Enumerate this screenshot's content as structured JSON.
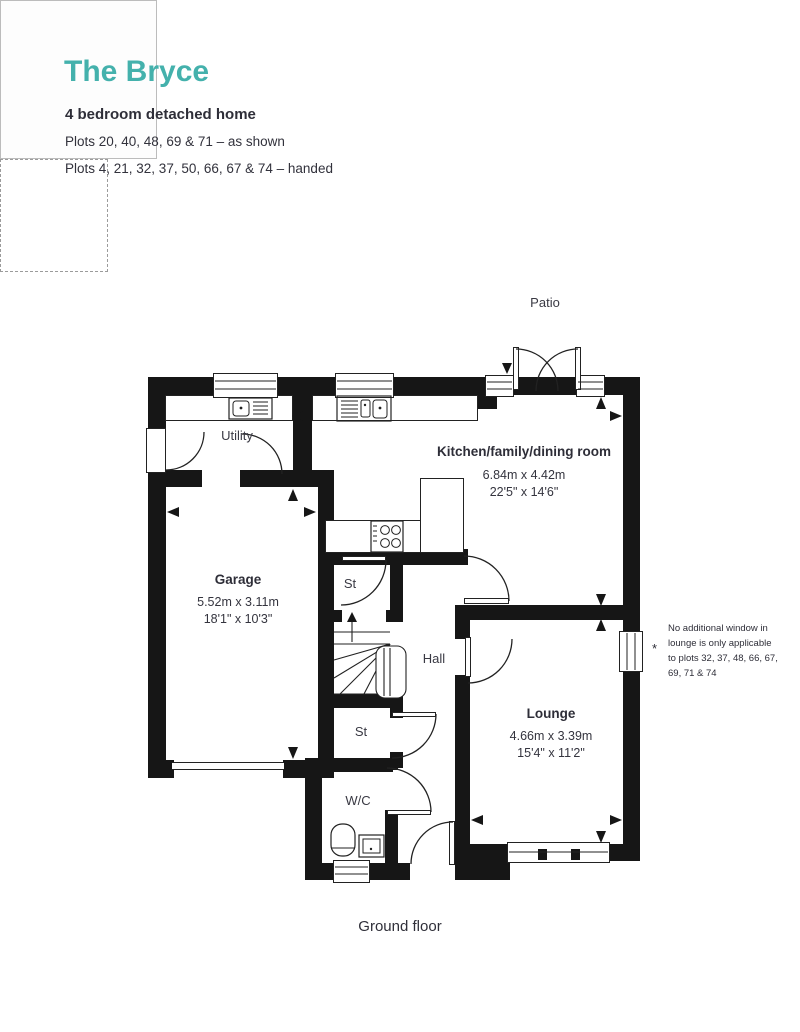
{
  "header": {
    "title": "The Bryce",
    "subtitle": "4 bedroom detached home",
    "plots_as_shown": "Plots 20, 40, 48, 69 & 71 – as shown",
    "plots_handed": "Plots 4, 21, 32, 37, 50, 66, 67 & 74 – handed"
  },
  "floor_label": "Ground floor",
  "note": {
    "marker": "*",
    "text": "No additional window in lounge is only applicable to plots 32, 37, 48, 66, 67, 69, 71 & 74"
  },
  "rooms": {
    "patio": {
      "name": "Patio"
    },
    "utility": {
      "name": "Utility"
    },
    "kitchen": {
      "name": "Kitchen/family/dining room",
      "metric": "6.84m x 4.42m",
      "imperial": "22'5\" x 14'6\""
    },
    "garage": {
      "name": "Garage",
      "metric": "5.52m x 3.11m",
      "imperial": "18'1\" x 10'3\""
    },
    "store_top": {
      "name": "St"
    },
    "hall": {
      "name": "Hall"
    },
    "store_bottom": {
      "name": "St"
    },
    "wc": {
      "name": "W/C"
    },
    "lounge": {
      "name": "Lounge",
      "metric": "4.66m x 3.39m",
      "imperial": "15'4\" x 11'2\""
    }
  },
  "colors": {
    "accent": "#44b1ac",
    "text": "#2e2e38",
    "wall": "#161616"
  }
}
